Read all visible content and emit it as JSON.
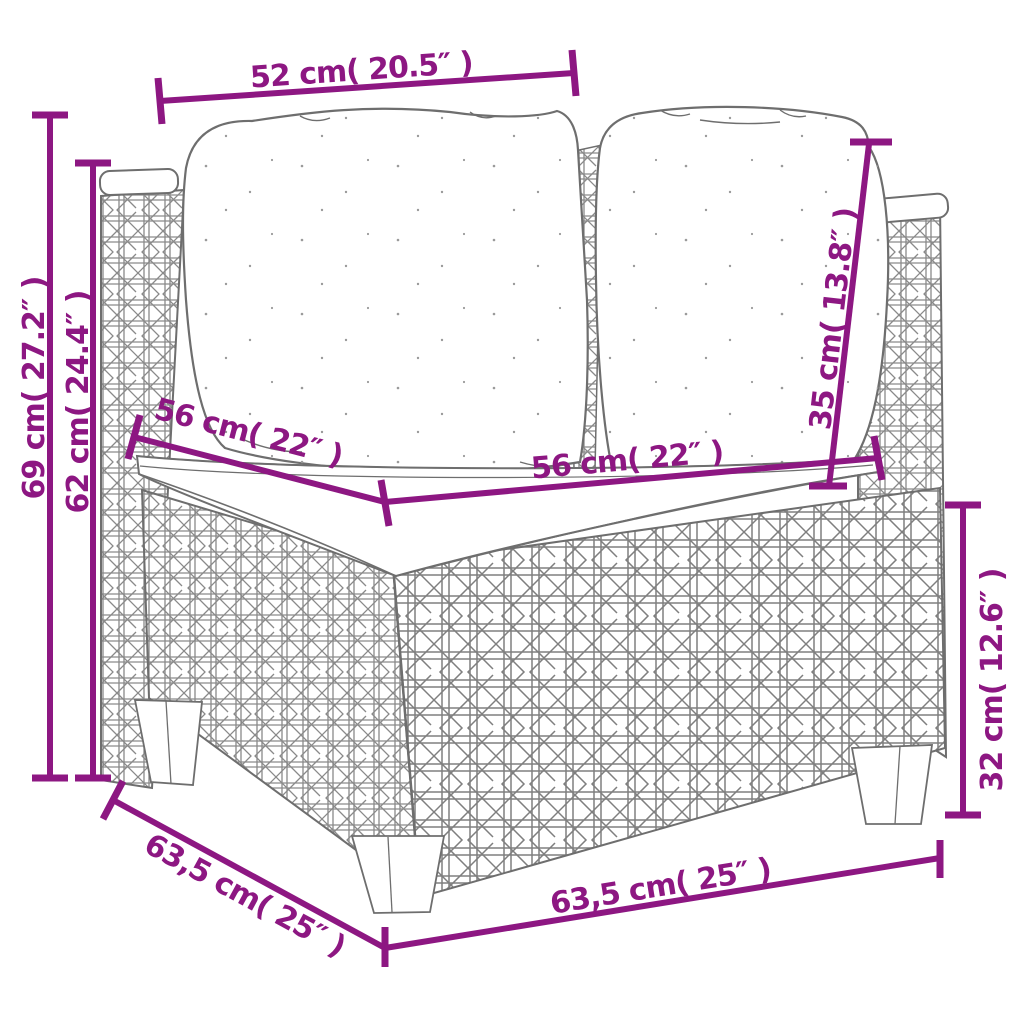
{
  "diagram": {
    "kind": "furniture-dimension-drawing",
    "subject": "rattan corner sofa section with cushions",
    "dimension_color": "#8D1782",
    "line_art_color": "#6E6E6E",
    "labels": {
      "top_width": "52 cm( 20.5″ )",
      "overall_height": "69 cm( 27.2″ )",
      "arm_height": "62 cm( 24.4″ )",
      "seat_depth": "56 cm( 22″ )",
      "seat_width": "56 cm( 22″ )",
      "backrest_height": "35 cm( 13.8″ )",
      "base_height": "32 cm( 12.6″ )",
      "overall_depth": "63,5 cm( 25″ )",
      "overall_width": "63,5 cm( 25″ )"
    }
  }
}
